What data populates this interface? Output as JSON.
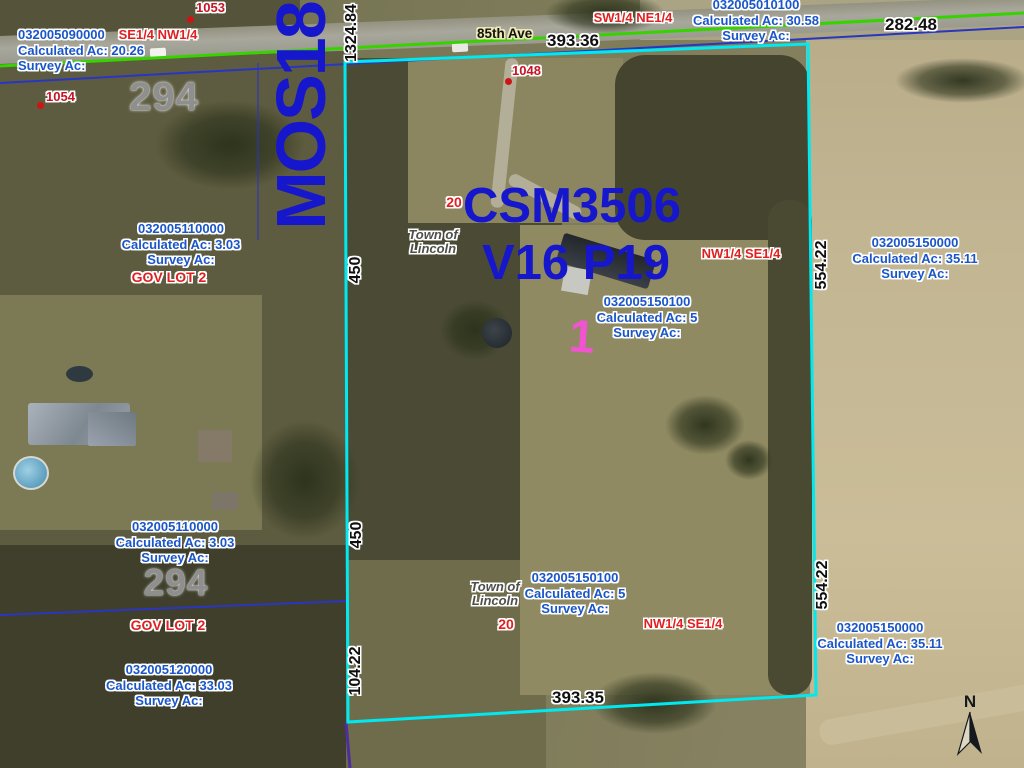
{
  "colors": {
    "parcel_boundary_cyan": "#00e8f0",
    "road_centerline_green": "#36d300",
    "lot_line_blue": "#2a35c0",
    "section_line_purple": "#4b2f9e",
    "parcel_text_blue": "#1a56c8",
    "quarter_text_red": "#e02020",
    "big_text_blue": "#1616cc",
    "lot_number_pink": "#f253d0",
    "address_text_red": "#c41424",
    "dimension_text_black": "#101010",
    "section_number_gray": "#8b8b8b"
  },
  "road": {
    "name": "85th Ave"
  },
  "labels": {
    "mos": "MOS18",
    "csm_line1": "CSM3506",
    "csm_line2": "V16 P19",
    "lot_number": "1",
    "north": "N",
    "town_upper": "Town of\nLincoln",
    "town_lower": "Town of\nLincoln",
    "sec20_upper": "20",
    "sec20_lower": "20",
    "sec294_upper": "294",
    "sec294_lower": "294",
    "govlot_upper": "GOV LOT 2",
    "govlot_lower": "GOV LOT 2",
    "quarter_se_nw": "SE1/4 NW1/4",
    "quarter_sw_ne": "SW1/4 NE1/4",
    "quarter_nw_se_upper": "NW1/4 SE1/4",
    "quarter_nw_se_lower": "NW1/4 SE1/4"
  },
  "parcels": {
    "p090000": {
      "id": "032005090000",
      "calc": "Calculated Ac: 20.26",
      "survey": "Survey Ac:"
    },
    "p010100": {
      "id": "032005010100",
      "calc": "Calculated Ac: 30.58",
      "survey": "Survey Ac:"
    },
    "p110000_upper": {
      "id": "032005110000",
      "calc": "Calculated Ac: 3.03",
      "survey": "Survey Ac:"
    },
    "p110000_lower": {
      "id": "032005110000",
      "calc": "Calculated Ac: 3.03",
      "survey": "Survey Ac:"
    },
    "p120000": {
      "id": "032005120000",
      "calc": "Calculated Ac: 33.03",
      "survey": "Survey Ac:"
    },
    "p150000_upper": {
      "id": "032005150000",
      "calc": "Calculated Ac: 35.11",
      "survey": "Survey Ac:"
    },
    "p150000_lower": {
      "id": "032005150000",
      "calc": "Calculated Ac: 35.11",
      "survey": "Survey Ac:"
    },
    "p150100_upper": {
      "id": "032005150100",
      "calc": "Calculated Ac: 5",
      "survey": "Survey Ac:"
    },
    "p150100_lower": {
      "id": "032005150100",
      "calc": "Calculated Ac: 5",
      "survey": "Survey Ac:"
    }
  },
  "dimensions": {
    "west_road_frontage": "1324.84",
    "north_top": "393.36",
    "north_right": "282.48",
    "west_upper": "450",
    "west_lower": "450",
    "west_bottom": "104.22",
    "east_upper": "554.22",
    "east_lower": "554.22",
    "south_bottom": "393.35"
  },
  "addresses": [
    {
      "number": "1053"
    },
    {
      "number": "1054"
    },
    {
      "number": "1048"
    }
  ]
}
